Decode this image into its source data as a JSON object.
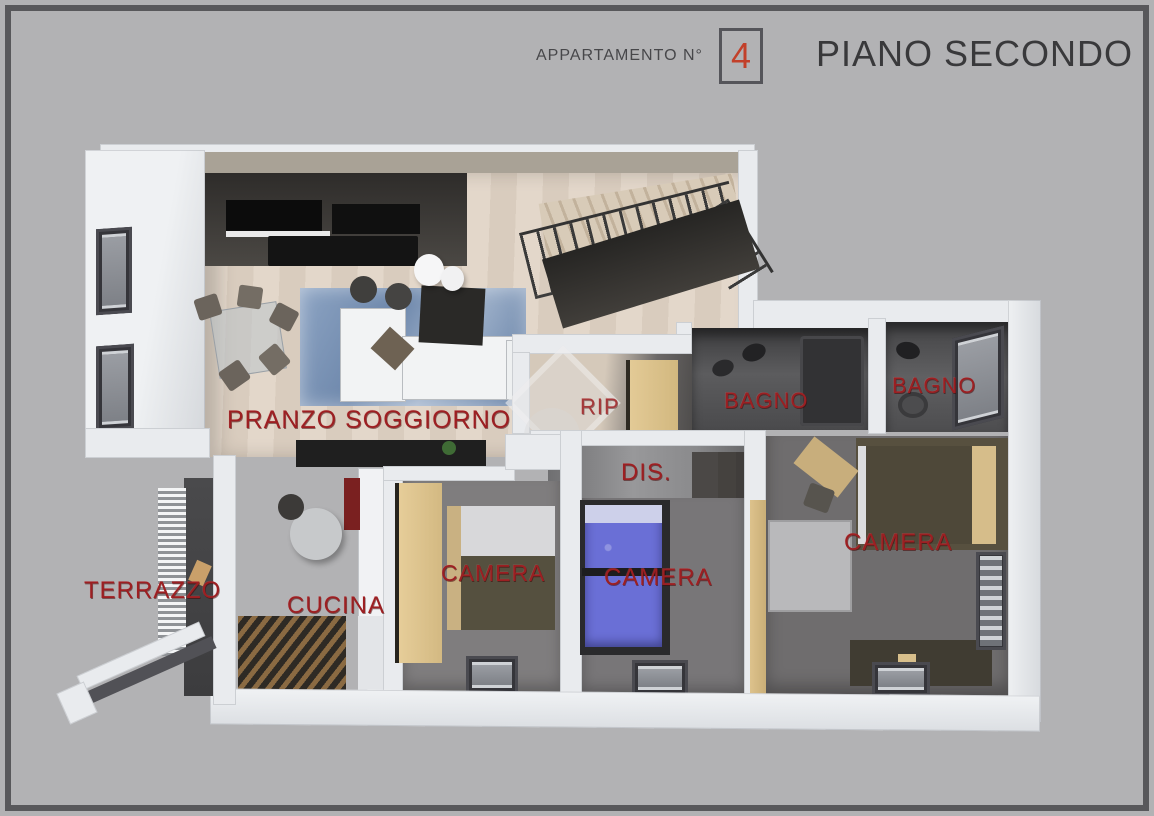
{
  "header": {
    "apartment_label": "APPARTAMENTO N°",
    "apartment_number": "4",
    "floor_title": "PIANO SECONDO"
  },
  "rooms": [
    {
      "id": "pranzo-soggiorno",
      "label": "PRANZO SOGGIORNO"
    },
    {
      "id": "rip",
      "label": "RIP"
    },
    {
      "id": "bagno-1",
      "label": "BAGNO"
    },
    {
      "id": "bagno-2",
      "label": "BAGNO"
    },
    {
      "id": "dis",
      "label": "DIS."
    },
    {
      "id": "camera-1",
      "label": "CAMERA"
    },
    {
      "id": "camera-2",
      "label": "CAMERA"
    },
    {
      "id": "camera-3",
      "label": "CAMERA"
    },
    {
      "id": "cucina",
      "label": "CUCINA"
    },
    {
      "id": "terrazzo",
      "label": "TERRAZZO"
    }
  ],
  "colors": {
    "background": "#b2b2b4",
    "frame": "#58585b",
    "label_red": "#9c1f22",
    "number_red": "#c2402a",
    "wall_white": "#e9ebee",
    "wood_floor": "#ddd1c4",
    "dark_floor": "#6f6d6e",
    "tan_furniture": "#d9c08c",
    "blue_bed": "#6a6fd6",
    "blue_rug": "#7e96b8",
    "taupe_band": "#a9a296"
  }
}
